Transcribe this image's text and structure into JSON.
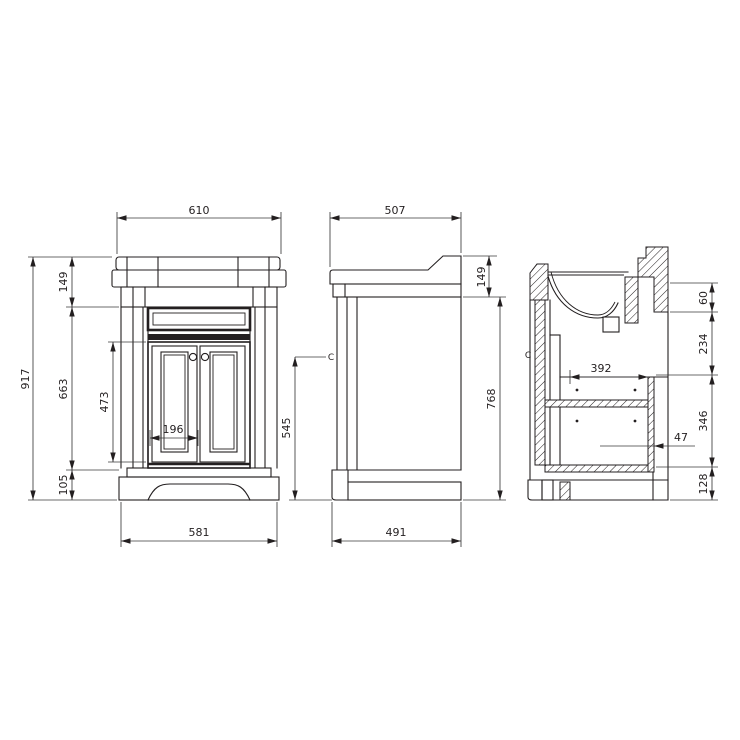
{
  "front": {
    "dims": {
      "width_top": "610",
      "height_total": "917",
      "worktop": "149",
      "body": "663",
      "doors": "473",
      "door_panel": "196",
      "plinth": "105",
      "width_base": "581"
    }
  },
  "side": {
    "dims": {
      "depth_top": "507",
      "worktop": "149",
      "body": "768",
      "centerline": "545",
      "depth_base": "491"
    },
    "centerline_marker": "C"
  },
  "section": {
    "dims": {
      "top_gap": "60",
      "basin": "234",
      "interior_width": "392",
      "shelf_gap": "346",
      "panel": "47",
      "plinth": "128"
    },
    "centerline_marker": "C"
  }
}
